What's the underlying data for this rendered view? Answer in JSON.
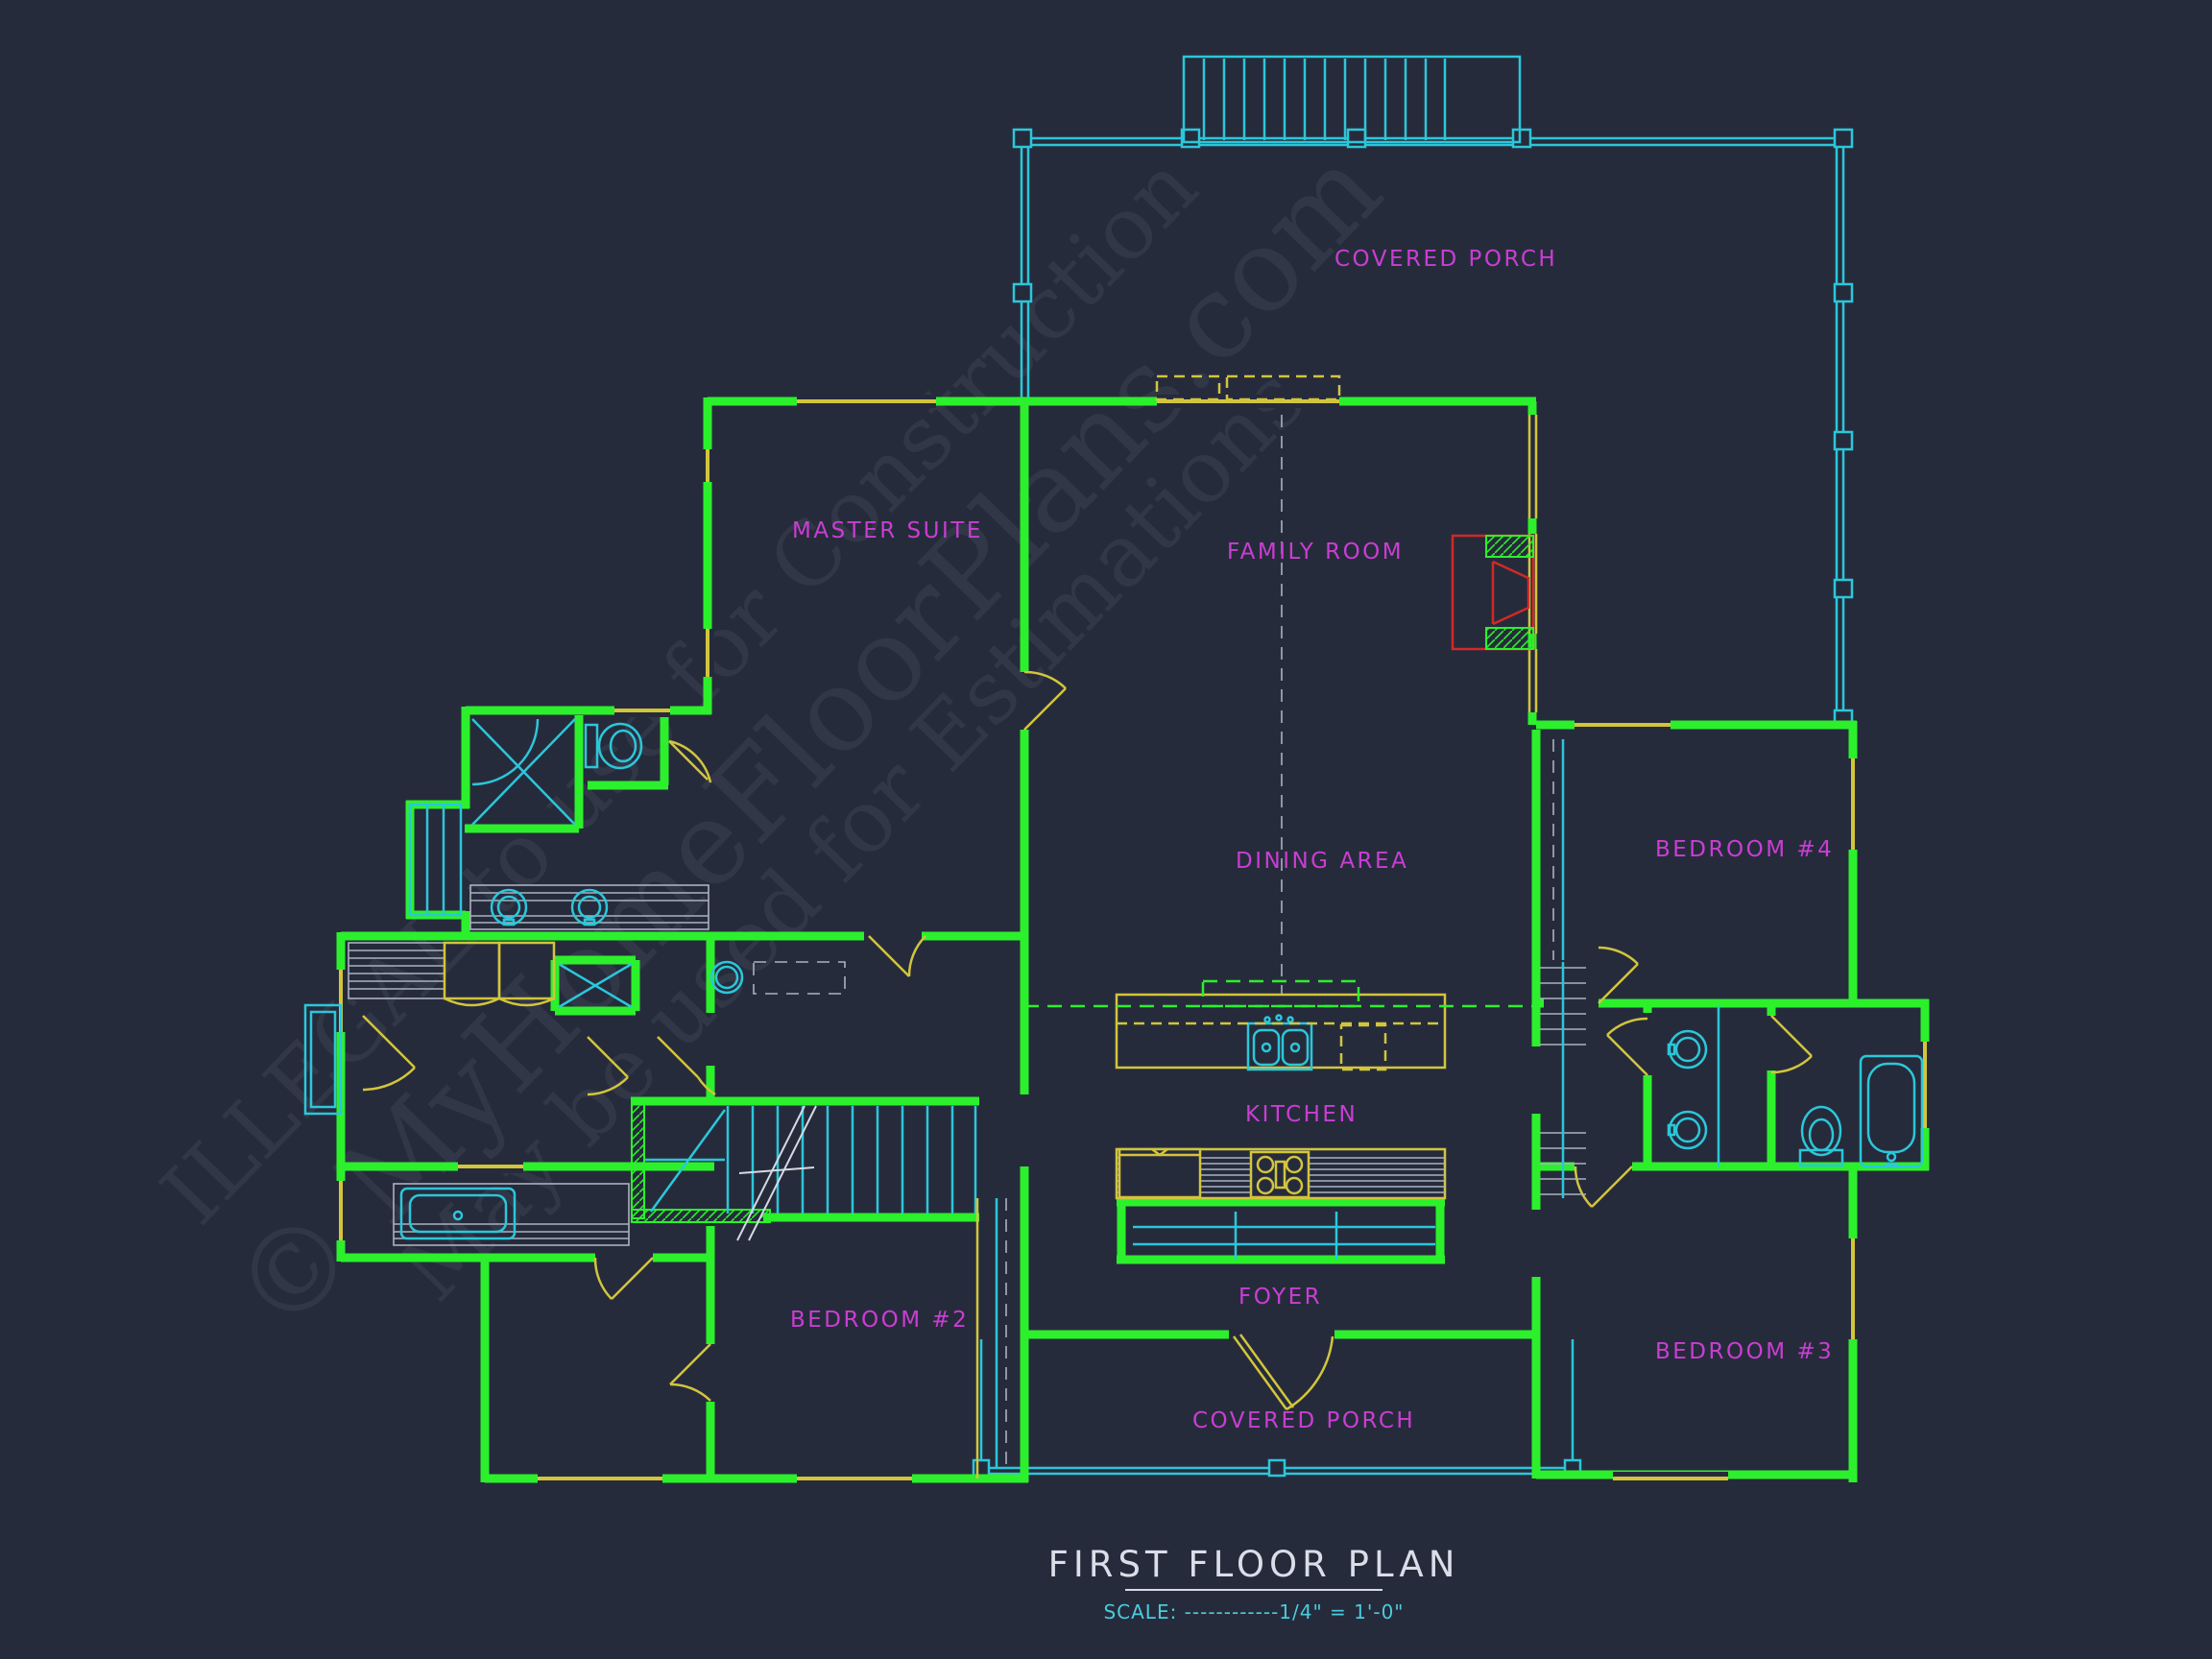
{
  "watermark": {
    "line1": "© MyHomeFloorPlans.com",
    "line2": "ILLEGAL to use for Construction",
    "line3": "May be used for Estimations"
  },
  "labels": {
    "covered_porch_top": "COVERED PORCH",
    "master_suite": "MASTER SUITE",
    "family_room": "FAMILY ROOM",
    "dining_area": "DINING AREA",
    "bedroom_4": "BEDROOM #4",
    "kitchen": "KITCHEN",
    "foyer": "FOYER",
    "bedroom_2": "BEDROOM #2",
    "bedroom_3": "BEDROOM #3",
    "covered_porch_bottom": "COVERED PORCH"
  },
  "title_block": {
    "title": "FIRST FLOOR PLAN",
    "scale": "SCALE: ------------1/4\" = 1'-0\""
  },
  "colors": {
    "background": "#262b3c",
    "walls": "#2cf02c",
    "porch_and_fixtures": "#2bc7d9",
    "windows_doors": "#d2c53c",
    "room_labels": "#c93ed2",
    "fireplace": "#cf2b26",
    "counters": "#aab1bf",
    "title_text": "#d9dee8"
  }
}
